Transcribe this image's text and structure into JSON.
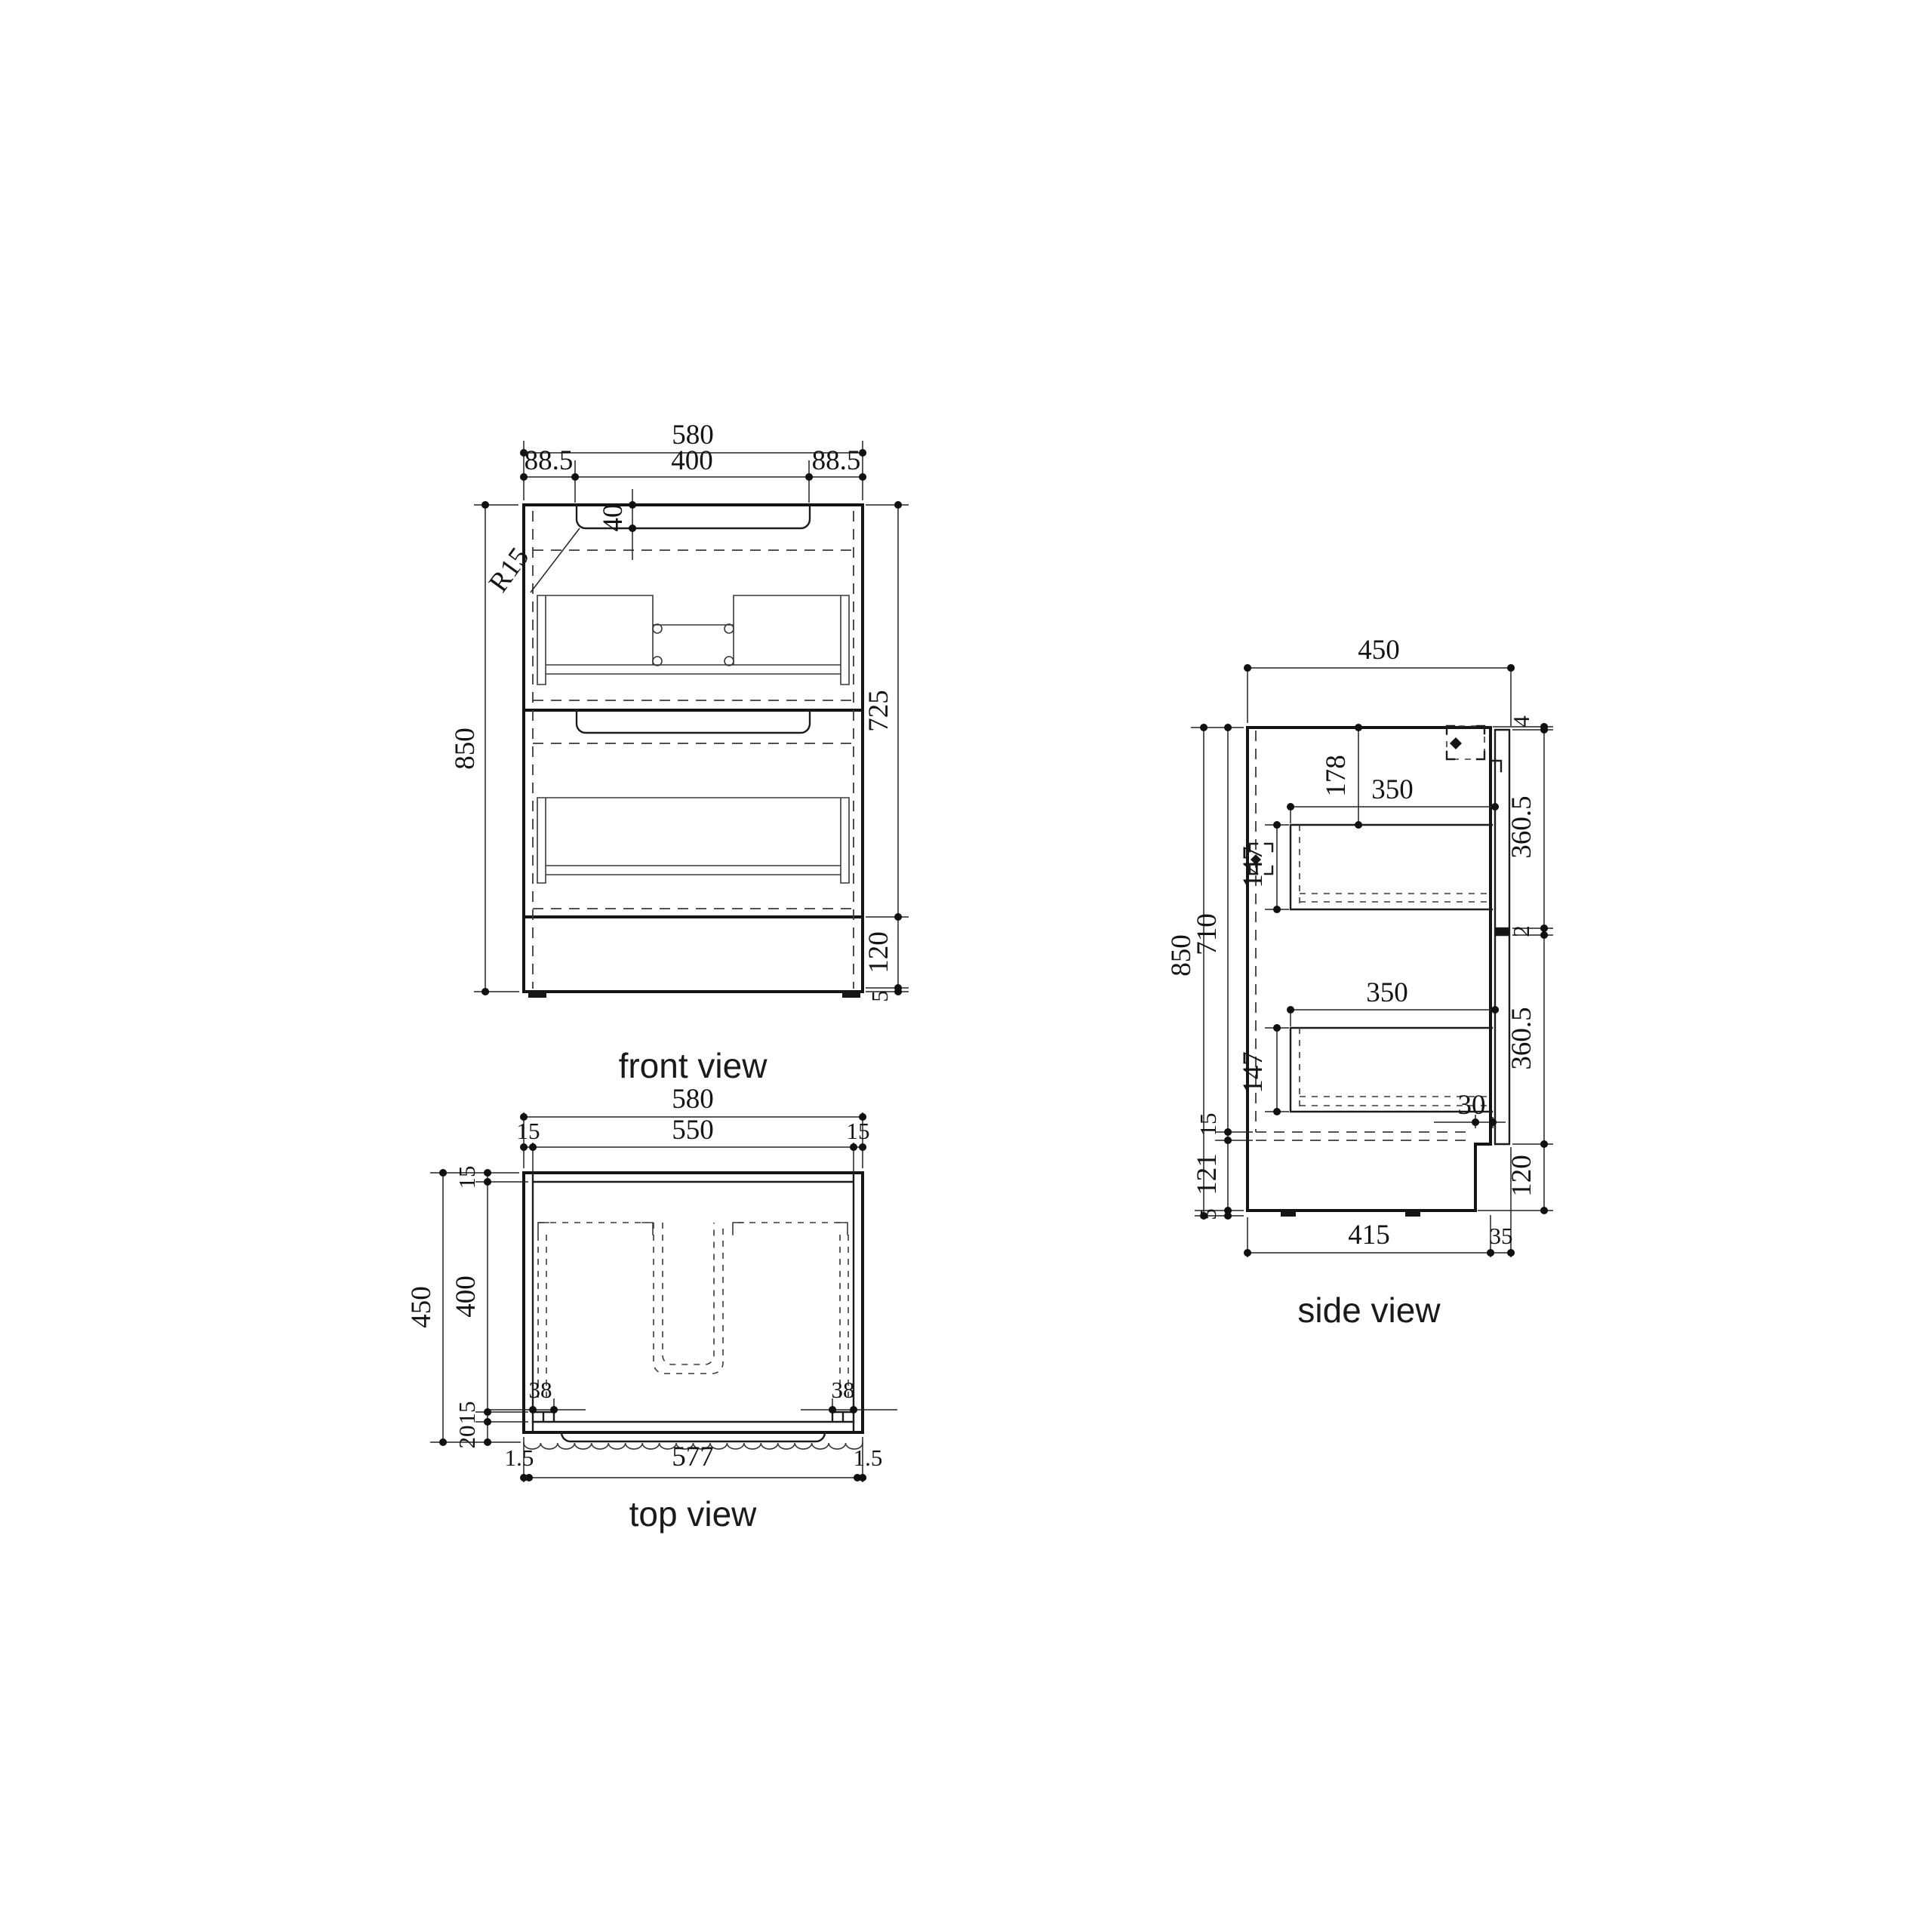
{
  "front": {
    "label": "front view",
    "total_width": "580",
    "left_offset": "88.5",
    "groove_width": "400",
    "right_offset": "88.5",
    "groove_depth": "40",
    "corner_radius": "R15",
    "total_height": "850",
    "upper_height": "725",
    "plinth_height": "120",
    "foot_height": "5"
  },
  "top": {
    "label": "top view",
    "total_width": "580",
    "wall_left": "15",
    "inner_width": "550",
    "wall_right": "15",
    "total_depth": "450",
    "inner_depth": "400",
    "back_wall": "15",
    "front_wall": "15",
    "front_panel": "20",
    "slide_left": "38",
    "slide_right": "38",
    "edge_left": "1.5",
    "front_width": "577",
    "edge_right": "1.5"
  },
  "side": {
    "label": "side view",
    "total_depth": "450",
    "drawer_top_offset": "178",
    "drawer_depth_upper": "350",
    "drawer_height_upper": "147",
    "drawer_depth_lower": "350",
    "drawer_height_lower": "147",
    "front_gap": "30",
    "top_gap": "4",
    "front_upper": "360.5",
    "between_gap": "2",
    "front_lower": "360.5",
    "plinth_height": "120",
    "total_height": "850",
    "carcass_height": "710",
    "bottom_panel": "15",
    "plinth_inner": "121",
    "foot_height": "5",
    "body_depth": "415",
    "front_thickness": "35"
  }
}
